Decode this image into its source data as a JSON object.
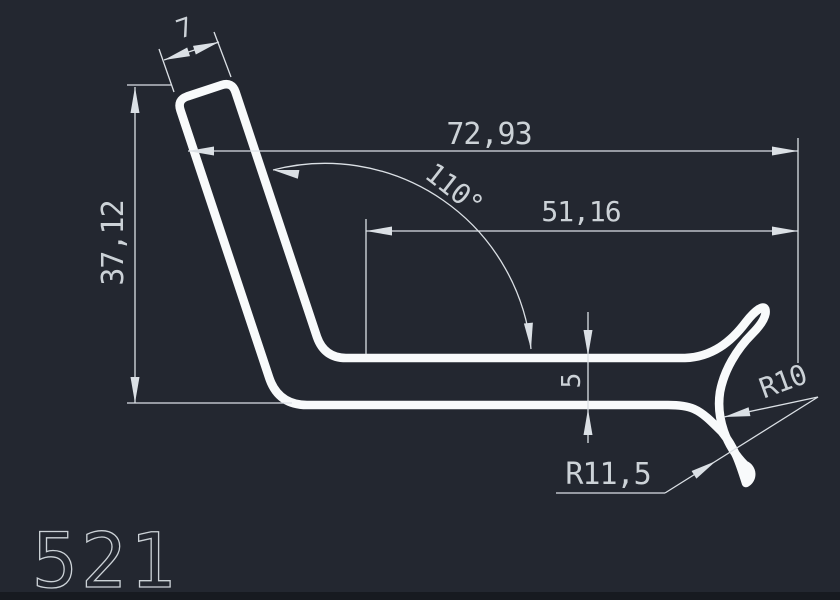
{
  "drawing": {
    "profile_number": "521",
    "dimensions": {
      "cap_width": "7",
      "height": "37,12",
      "overall_width": "72,93",
      "angle": "110°",
      "inner_width": "51,16",
      "thickness": "5",
      "radius_small": "R10",
      "radius_large": "R11,5"
    }
  },
  "colors": {
    "background": "#232730",
    "profile_line": "#f8fafb",
    "dimension_line": "#dbe0e5",
    "text": "#ccd2d7",
    "bottom_strip": "#171a20"
  }
}
